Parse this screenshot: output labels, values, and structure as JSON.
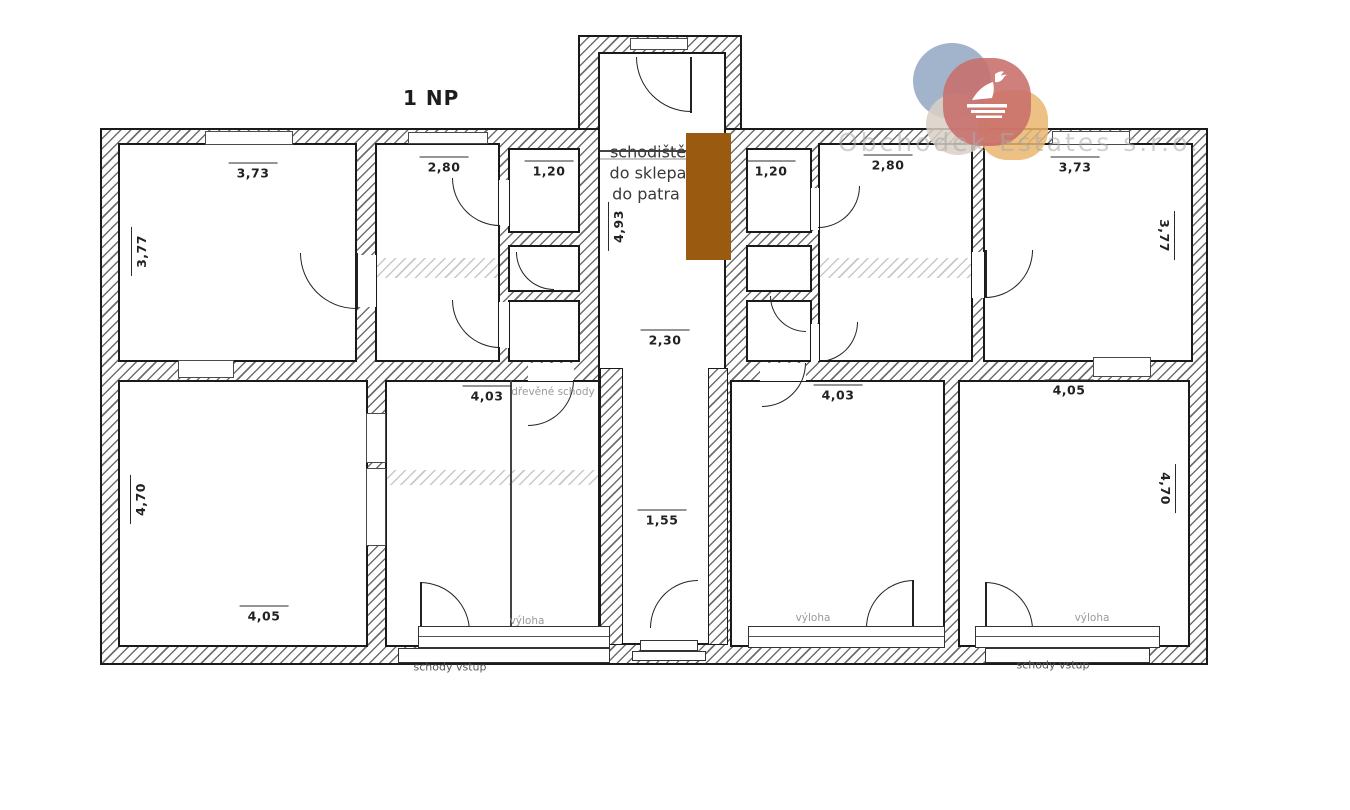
{
  "title": "1 NP",
  "watermark": "Obchodek Estates s.r.o.",
  "stair_note": {
    "line1": "schodiště",
    "line2": "do sklepa",
    "line3": "do patra"
  },
  "annotations": {
    "drevene_schody": "dřevěné schody",
    "vyloha_left": "výloha",
    "vyloha_mid": "výloha",
    "vyloha_right": "výloha",
    "schody_vstup_left": "schody vstup",
    "schody_vstup_right": "schody vstup"
  },
  "dimensions": {
    "top_left_room_width": "3,73",
    "top_left_room_height": "3,77",
    "left_room2_width": "2,80",
    "left_closet_width": "1,20",
    "staircase_depth": "4,93",
    "right_closet_width": "1,20",
    "right_room2_width": "2,80",
    "top_right_room_width": "3,73",
    "top_right_room_height": "3,77",
    "hall_width": "2,30",
    "bottom_mid_left_width": "4,03",
    "bottom_mid_right_width": "4,03",
    "bottom_right_width": "4,05",
    "bottom_left_height": "4,70",
    "corridor_width": "1,55",
    "bottom_left_width": "4,05",
    "bottom_right_height": "4,70"
  },
  "colors": {
    "wall": "#1a1a1a",
    "stair_highlight": "#9a5a10",
    "watermark": "#aaaaaa",
    "logo_blue": "#92a7c2",
    "logo_red": "#c86e6b",
    "logo_beige": "#d9d0c4",
    "logo_orange": "#eab56e"
  }
}
